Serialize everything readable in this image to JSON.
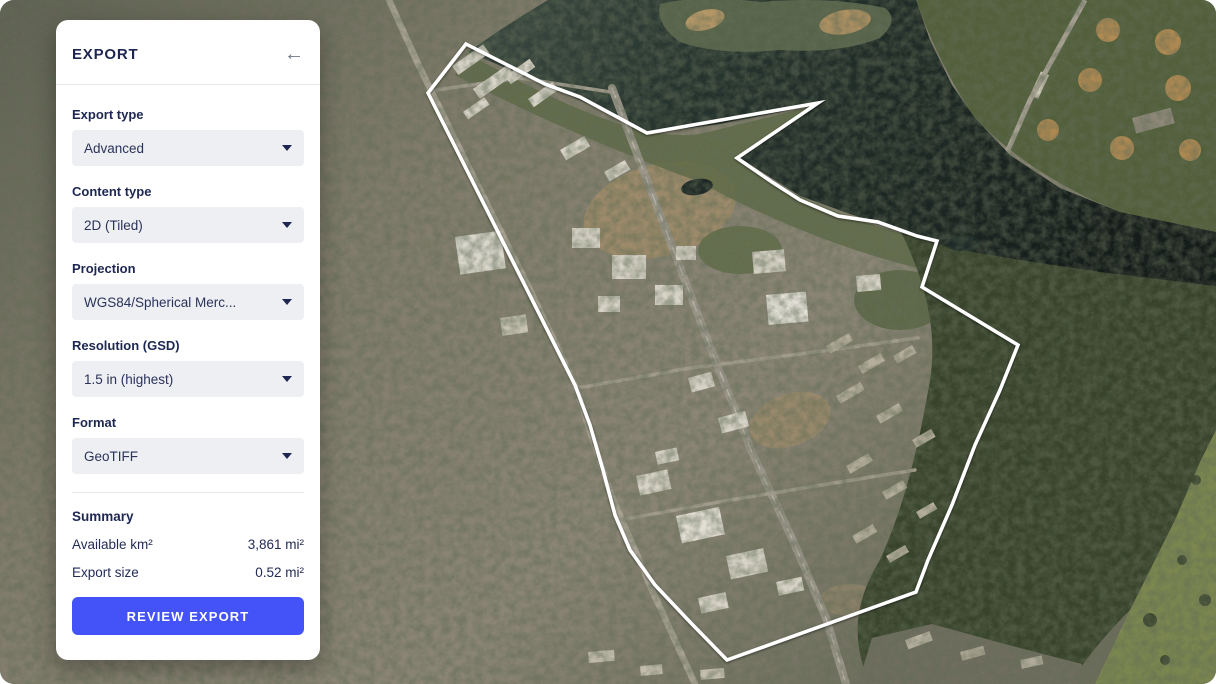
{
  "panel": {
    "title": "EXPORT",
    "back_icon": "←",
    "fields": [
      {
        "label": "Export type",
        "value": "Advanced"
      },
      {
        "label": "Content type",
        "value": "2D (Tiled)"
      },
      {
        "label": "Projection",
        "value": "WGS84/Spherical Merc..."
      },
      {
        "label": "Resolution (GSD)",
        "value": "1.5 in (highest)"
      },
      {
        "label": "Format",
        "value": "GeoTIFF"
      }
    ],
    "summary": {
      "heading": "Summary",
      "rows": [
        {
          "label": "Available km²",
          "value": "3,861 mi²"
        },
        {
          "label": "Export size",
          "value": "0.52 mi²"
        }
      ]
    },
    "cta_label": "REVIEW EXPORT",
    "accent_color": "#4353f7",
    "text_color": "#1d2752"
  },
  "map": {
    "export_polygon_points": "466,44 545,84 580,97 647,133 818,103 737,158 772,182 800,200 838,216 878,222 917,236 937,241 922,287 1018,345 1000,390 975,445 952,505 928,560 916,592 727,660 690,622 655,585 630,550 615,515 603,470 590,425 575,385 428,93",
    "polygon_color": "#ffffff"
  }
}
